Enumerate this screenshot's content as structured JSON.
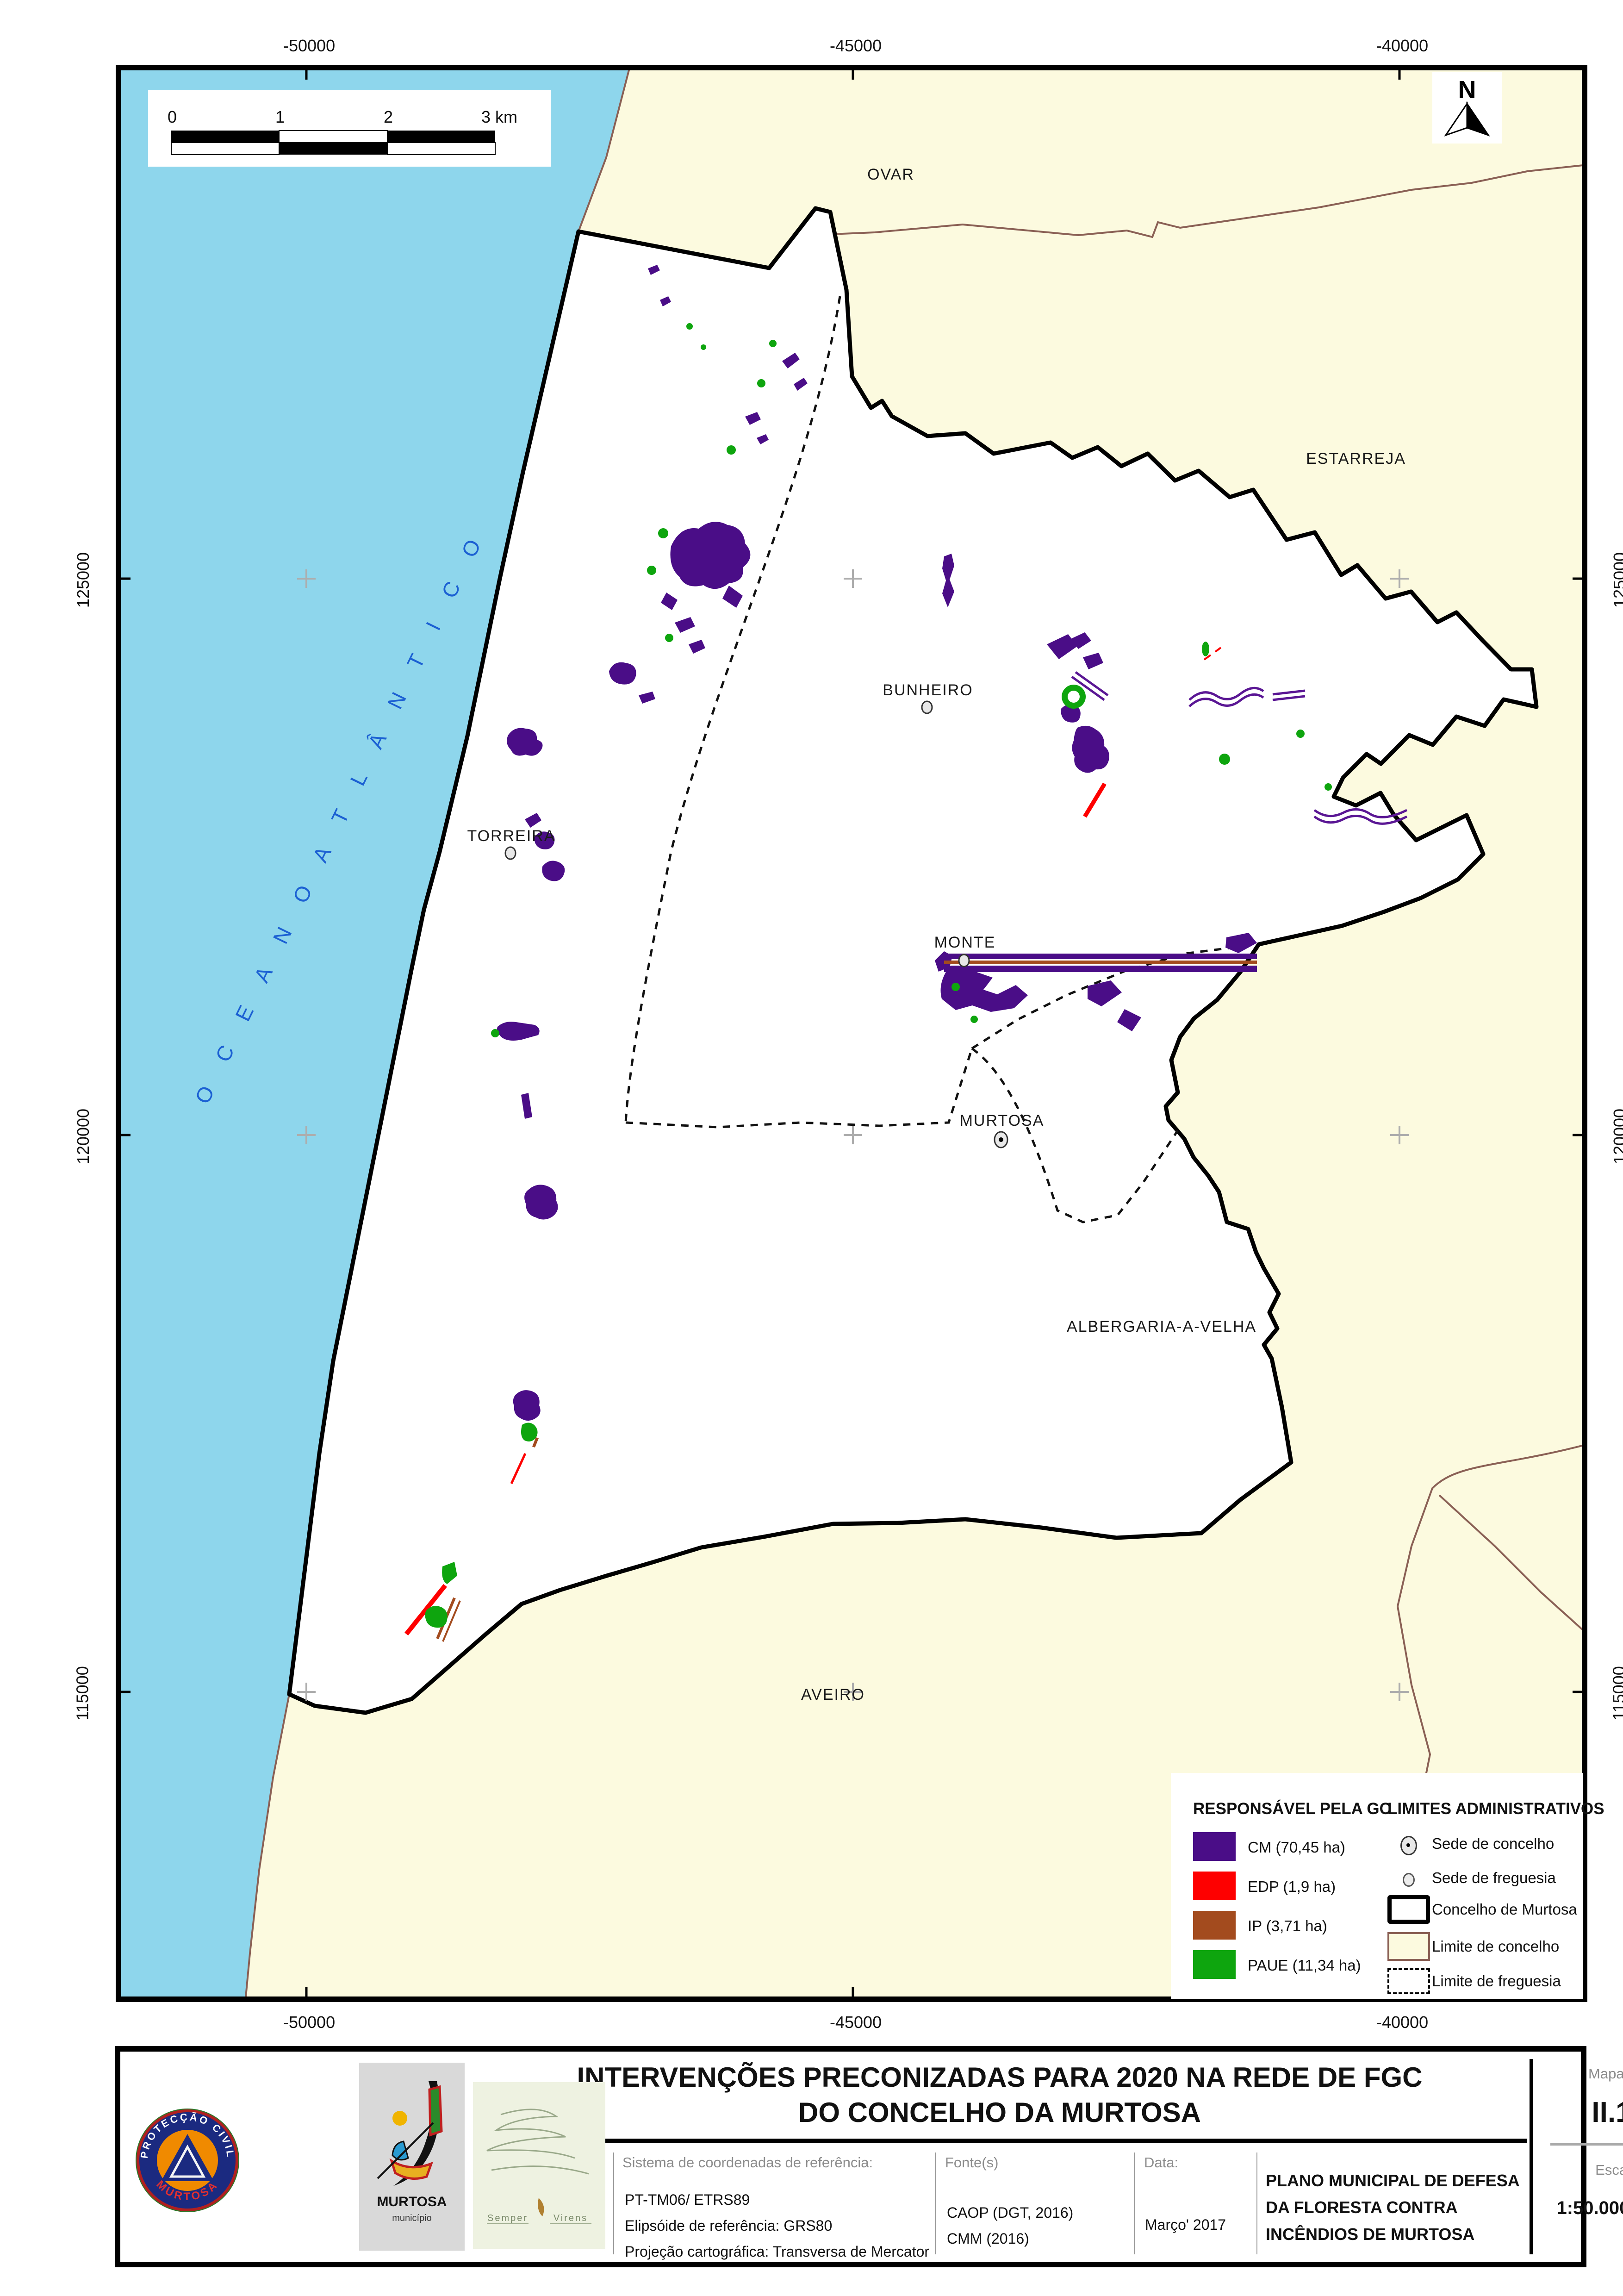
{
  "map": {
    "coords_top": [
      "-50000",
      "-45000",
      "-40000"
    ],
    "coords_bottom": [
      "-50000",
      "-45000",
      "-40000"
    ],
    "coords_left": [
      "125000",
      "120000",
      "115000"
    ],
    "coords_right": [
      "125000",
      "120000",
      "115000"
    ],
    "ocean_label": "O C E A N O   A T L Â N T I C O",
    "north_label": "N",
    "scalebar": {
      "t0": "0",
      "t1": "1",
      "t2": "2",
      "t3": "3 km"
    },
    "places": {
      "ovar": "OVAR",
      "estarreja": "ESTARREJA",
      "bunheiro": "BUNHEIRO",
      "torreira": "TORREIRA",
      "monte": "MONTE",
      "murtosa": "MURTOSA",
      "albergaria": "ALBERGARIA-A-VELHA",
      "aveiro": "AVEIRO"
    }
  },
  "legend": {
    "gc": {
      "title": "RESPONSÁVEL PELA GC",
      "items": [
        {
          "label": "CM (70,45 ha)"
        },
        {
          "label": "EDP (1,9 ha)"
        },
        {
          "label": "IP (3,71 ha)"
        },
        {
          "label": "PAUE (11,34 ha)"
        }
      ]
    },
    "admin": {
      "title": "LIMITES ADMINISTRATIVOS",
      "items": [
        "Sede de concelho",
        "Sede de freguesia",
        "Concelho de Murtosa",
        "Limite de concelho",
        "Limite de freguesia"
      ]
    },
    "colors": {
      "cm": "#4a0d87",
      "edp": "#fe0000",
      "ip": "#a34b1e",
      "paue": "#0ea50e",
      "ocean": "#8ed6ec",
      "neighbour": "#fcfadf"
    }
  },
  "titleblock": {
    "title_line1": "INTERVENÇÕES PRECONIZADAS PARA 2020 NA REDE DE FGC",
    "title_line2": "DO CONCELHO DA MURTOSA",
    "elaborado_label": "Elaborado por:",
    "coords_label": "Sistema de coordenadas de referência:",
    "coords_line1": "PT-TM06/ ETRS89",
    "coords_line2": "Elipsóide de referência: GRS80",
    "coords_line3": "Projeção cartográfica: Transversa de Mercator",
    "fontes_label": "Fonte(s)",
    "fontes_line1": "CAOP (DGT, 2016)",
    "fontes_line2": "CMM (2016)",
    "data_label": "Data:",
    "data_value": "Março' 2017",
    "plano_line1": "PLANO MUNICIPAL DE DEFESA",
    "plano_line2": "DA FLORESTA CONTRA",
    "plano_line3": "INCÊNDIOS DE MURTOSA",
    "mapa_label": "Mapa n.º:",
    "mapa_value": "II.11",
    "escala_label": "Escala:",
    "escala_value": "1:50.000",
    "escala_format": "(A3)",
    "logos": {
      "protecao_top": "PROTECÇÃO CIVIL",
      "protecao_bottom": "MURTOSA",
      "murtosa_name": "MURTOSA",
      "murtosa_sub": "município",
      "semper_left": "Semper",
      "semper_right": "Virens"
    }
  }
}
